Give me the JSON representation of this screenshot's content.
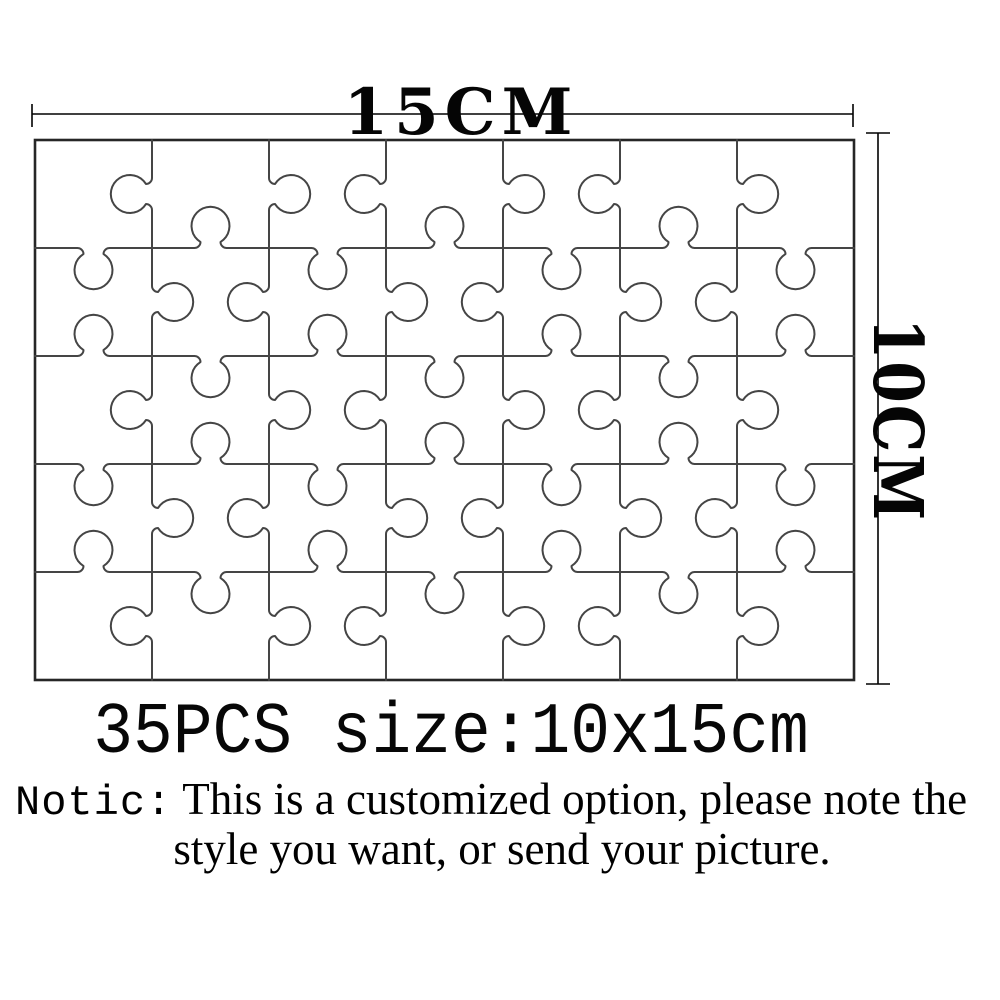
{
  "dimension_labels": {
    "width": "15CM",
    "height": "10CM"
  },
  "puzzle": {
    "rows": 5,
    "cols": 7,
    "pieces": 35
  },
  "caption": "35PCS size:10x15cm",
  "notice": {
    "prefix": "Notic:",
    "line1": "This is a customized option, please note the",
    "line2": "style you want, or send your picture."
  },
  "colors": {
    "background": "#ffffff",
    "piece_line": "#454545",
    "border_line": "#262626",
    "dimension_line": "#000000",
    "text": "#000000"
  }
}
